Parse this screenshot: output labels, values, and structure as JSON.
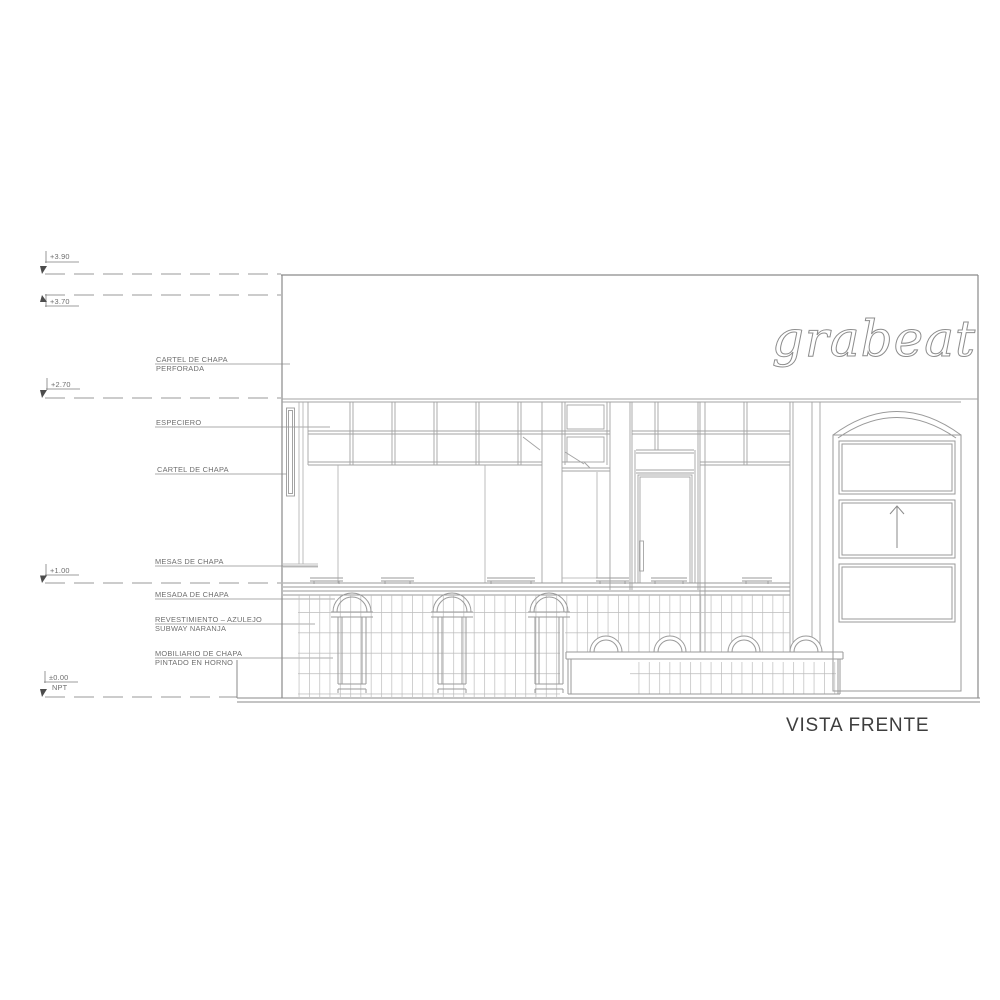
{
  "drawing": {
    "title": "VISTA FRENTE",
    "logo_text": "grabeat",
    "levels": [
      {
        "value": "+3.90",
        "note": ""
      },
      {
        "value": "+3.70",
        "note": ""
      },
      {
        "value": "+2.70",
        "note": ""
      },
      {
        "value": "+1.00",
        "note": ""
      },
      {
        "value": "±0.00",
        "note": "NPT"
      }
    ],
    "annotations": [
      {
        "line1": "CARTEL DE CHAPA",
        "line2": "PERFORADA"
      },
      {
        "line1": "ESPECIERO",
        "line2": ""
      },
      {
        "line1": "CARTEL DE CHAPA",
        "line2": ""
      },
      {
        "line1": "MESAS DE CHAPA",
        "line2": ""
      },
      {
        "line1": "MESADA DE CHAPA",
        "line2": ""
      },
      {
        "line1": "REVESTIMIENTO – AZULEJO",
        "line2": "SUBWAY NARANJA"
      },
      {
        "line1": "MOBILIARIO DE CHAPA",
        "line2": "PINTADO EN HORNO"
      }
    ]
  },
  "colors": {
    "background": "#ffffff",
    "line": "#a3a3a3",
    "frame": "#8a8a8a",
    "tile": "#b8b8b8",
    "label_text": "#6e6e6e",
    "title_text": "#3e3e3e",
    "marker": "#4c4c4c",
    "logo_stroke": "#8d8d8d"
  }
}
